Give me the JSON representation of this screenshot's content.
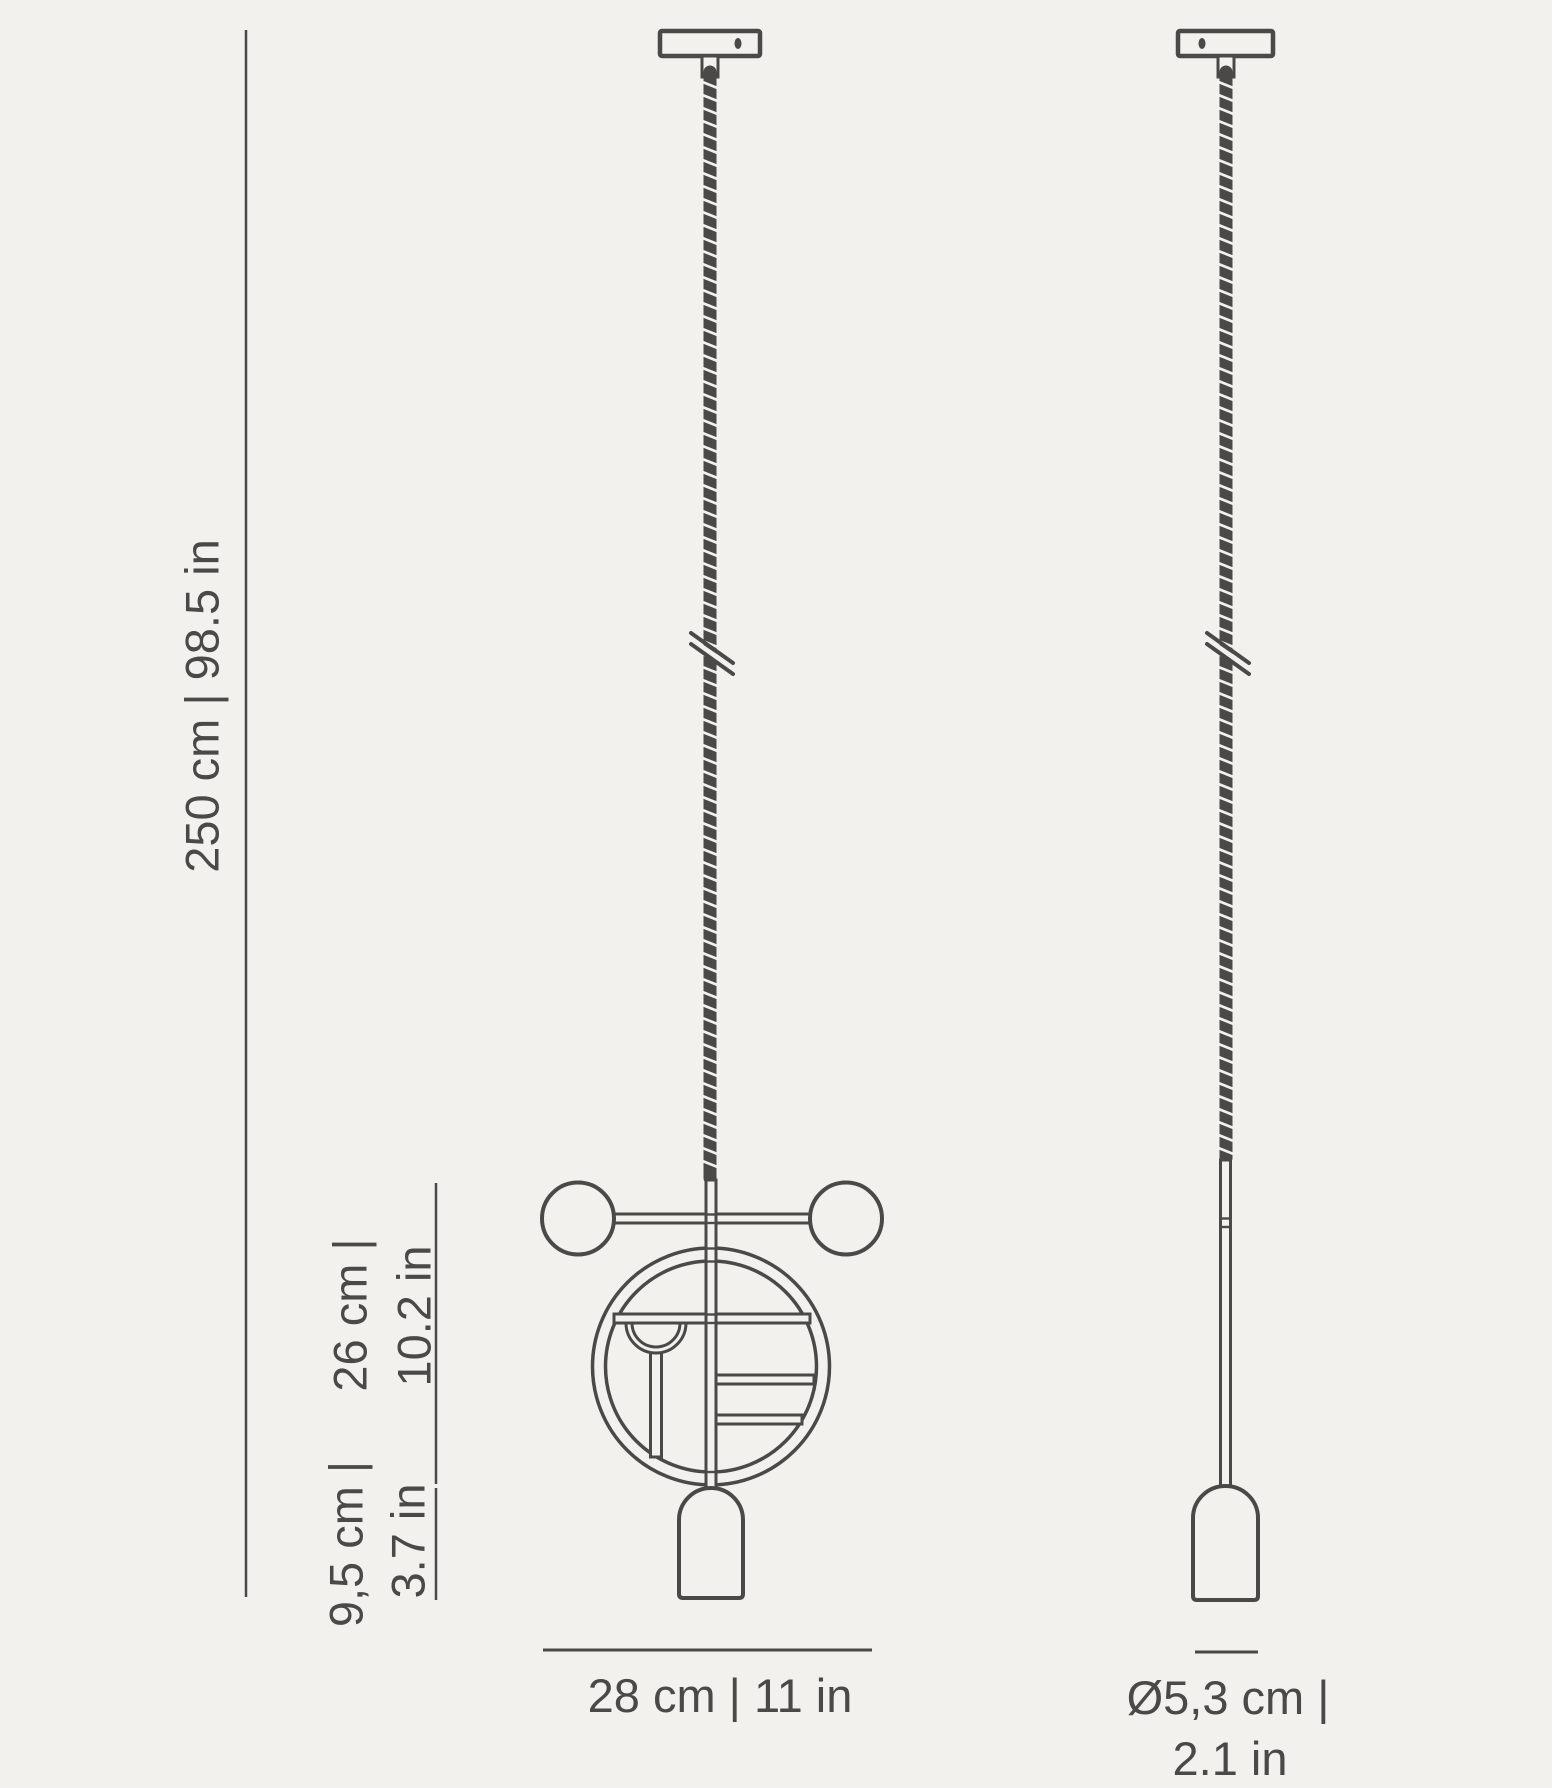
{
  "colors": {
    "background": "#f2f1ee",
    "line": "#4a4947"
  },
  "diagram": {
    "labels": {
      "overall_drop": "250 cm | 98.5 in",
      "fixture_height_cm": "26 cm |",
      "fixture_height_in": "10.2 in",
      "diffuser_height_cm": "9,5 cm |",
      "diffuser_height_in": "3.7 in",
      "fixture_width": "28 cm | 11 in",
      "diffuser_diameter_cm": "Ø5,3 cm |",
      "diffuser_diameter_in": "2.1 in"
    }
  }
}
